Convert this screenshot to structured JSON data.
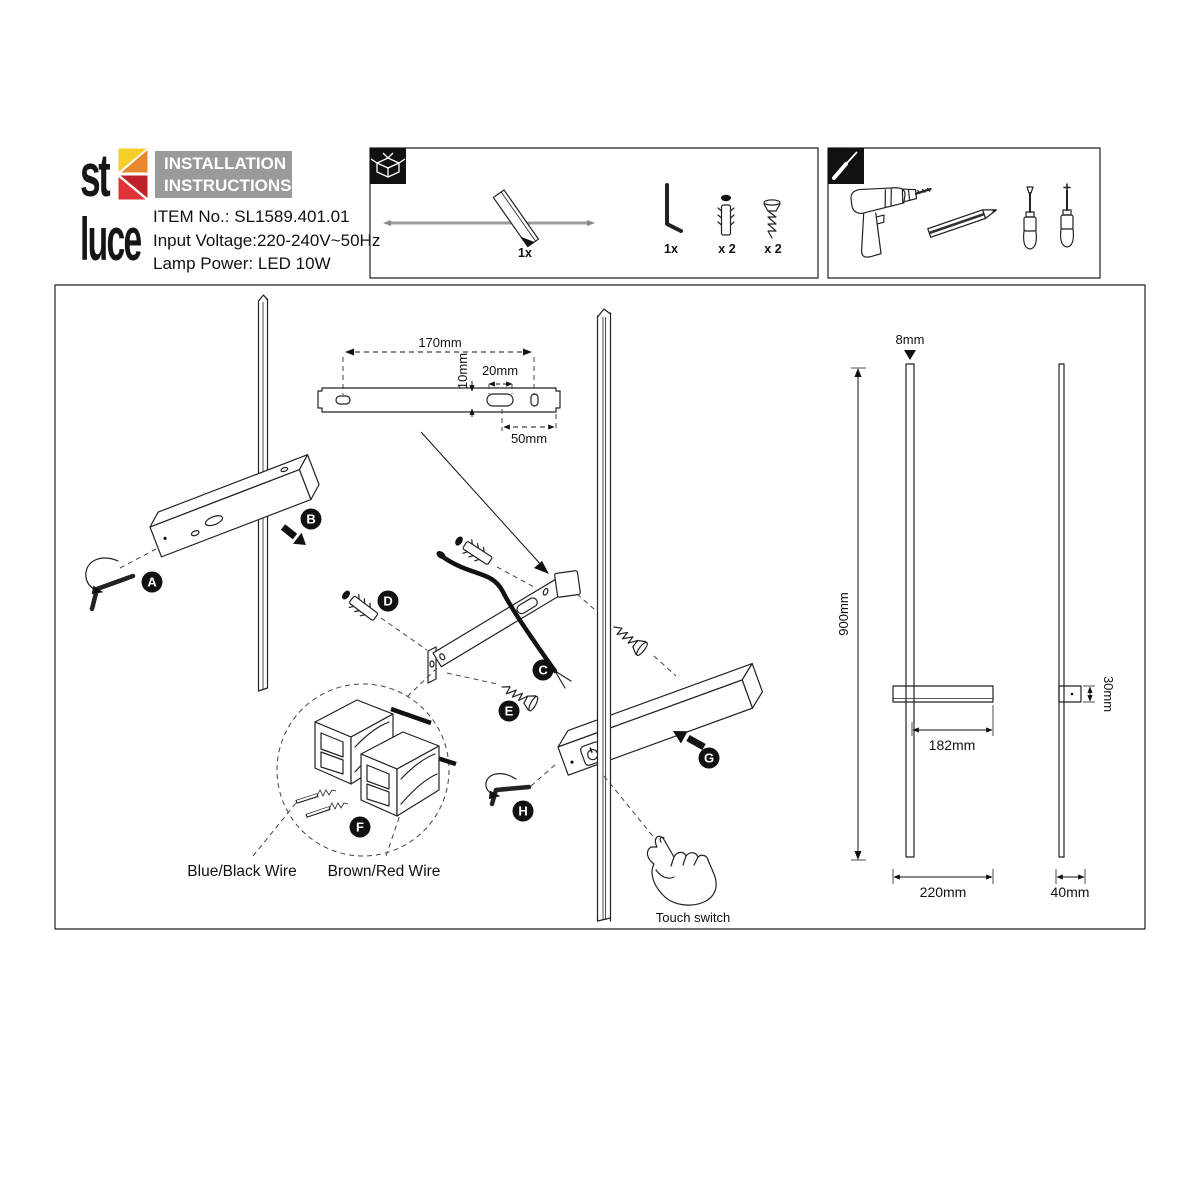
{
  "brand": {
    "logo_top": "st",
    "logo_bottom": "luce",
    "logo_colors": {
      "yellow": "#F4CF2A",
      "orange": "#E8872B",
      "red": "#E23438",
      "dark_red": "#BE2127"
    }
  },
  "header": {
    "title_line1": "INSTALLATION",
    "title_line2": "INSTRUCTIONS",
    "title_bg": "#9A9A9A",
    "item_no": "ITEM No.: SL1589.401.01",
    "input_voltage": "Input Voltage:220-240V~50Hz",
    "lamp_power": "Lamp Power: LED 10W"
  },
  "package_box": {
    "lamp_qty": "1x",
    "hex_key_qty": "1x",
    "anchor_qty": "x 2",
    "screw_qty": "x 2"
  },
  "bracket_dims": {
    "length": "170mm",
    "hole_height": "10mm",
    "slot_width": "20mm",
    "edge_offset": "50mm"
  },
  "steps": {
    "a": "A",
    "b": "B",
    "c": "C",
    "d": "D",
    "e": "E",
    "f": "F",
    "g": "G",
    "h": "H"
  },
  "wiring": {
    "left_label": "Blue/Black Wire",
    "right_label": "Brown/Red Wire"
  },
  "touch": {
    "label": "Touch switch"
  },
  "product_dims": {
    "rod_diameter": "8mm",
    "height": "900mm",
    "body_length": "182mm",
    "overall_width": "220mm",
    "body_depth": "30mm",
    "side_width": "40mm"
  }
}
